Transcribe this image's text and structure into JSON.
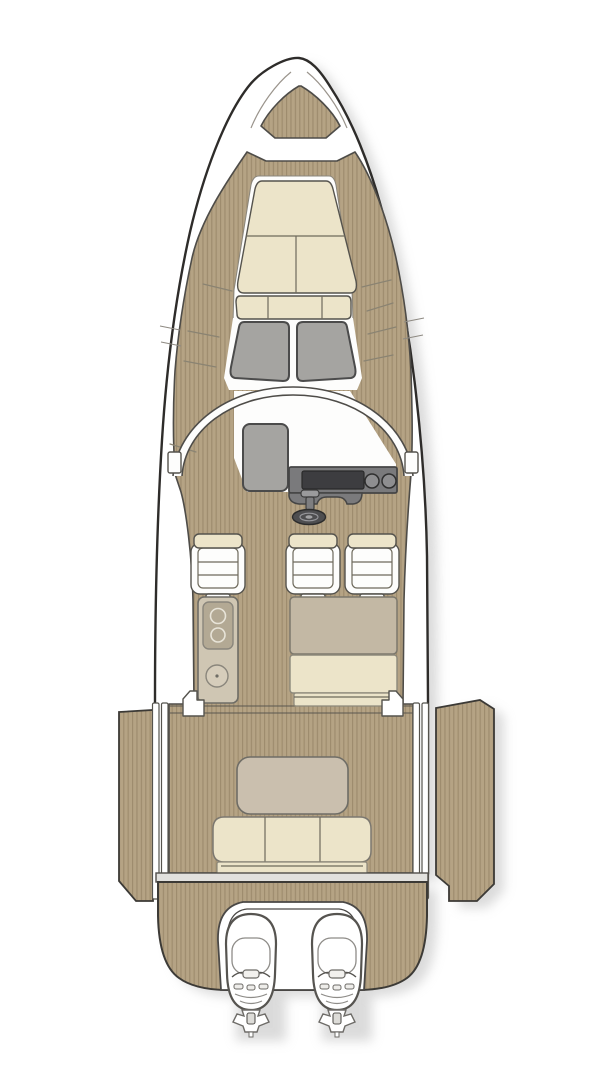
{
  "diagram": {
    "kind": "boat-deck-plan-top-view",
    "parts": {
      "helm_seat_count": 3,
      "outboard_engine_count": 2,
      "stove_burner_count": 2,
      "windshield_panel_count": 2,
      "dashboard_gauge_count": 2,
      "aft_bench_sections": 3,
      "sunpad_bolster_sections": 3,
      "fold_out_terrace_count": 2
    }
  },
  "colors": {
    "hull_white": "#ffffff",
    "trim_white": "#fdfdfc",
    "outline_dark": "#2e2c2a",
    "teak_base": "#b5a384",
    "teak_stripe": "#9d8b6d",
    "cushion_cream": "#ece4c9",
    "taupe": "#c3b8a4",
    "taupe_table": "#cabfae",
    "galley_body": "#cfc6b3",
    "galley_inset": "#b3a994",
    "sink_face": "#d6cdbb",
    "glass_gray": "#a5a4a1",
    "console_gray": "#7a7a7c",
    "screen_dark": "#3d3d40",
    "gauge_gray": "#8e8e90",
    "wheel_dark": "#4e4e50",
    "throttle_gray": "#9a9a9c",
    "rail_gray": "#e2e1de",
    "shadow": "#bdbdbd"
  }
}
